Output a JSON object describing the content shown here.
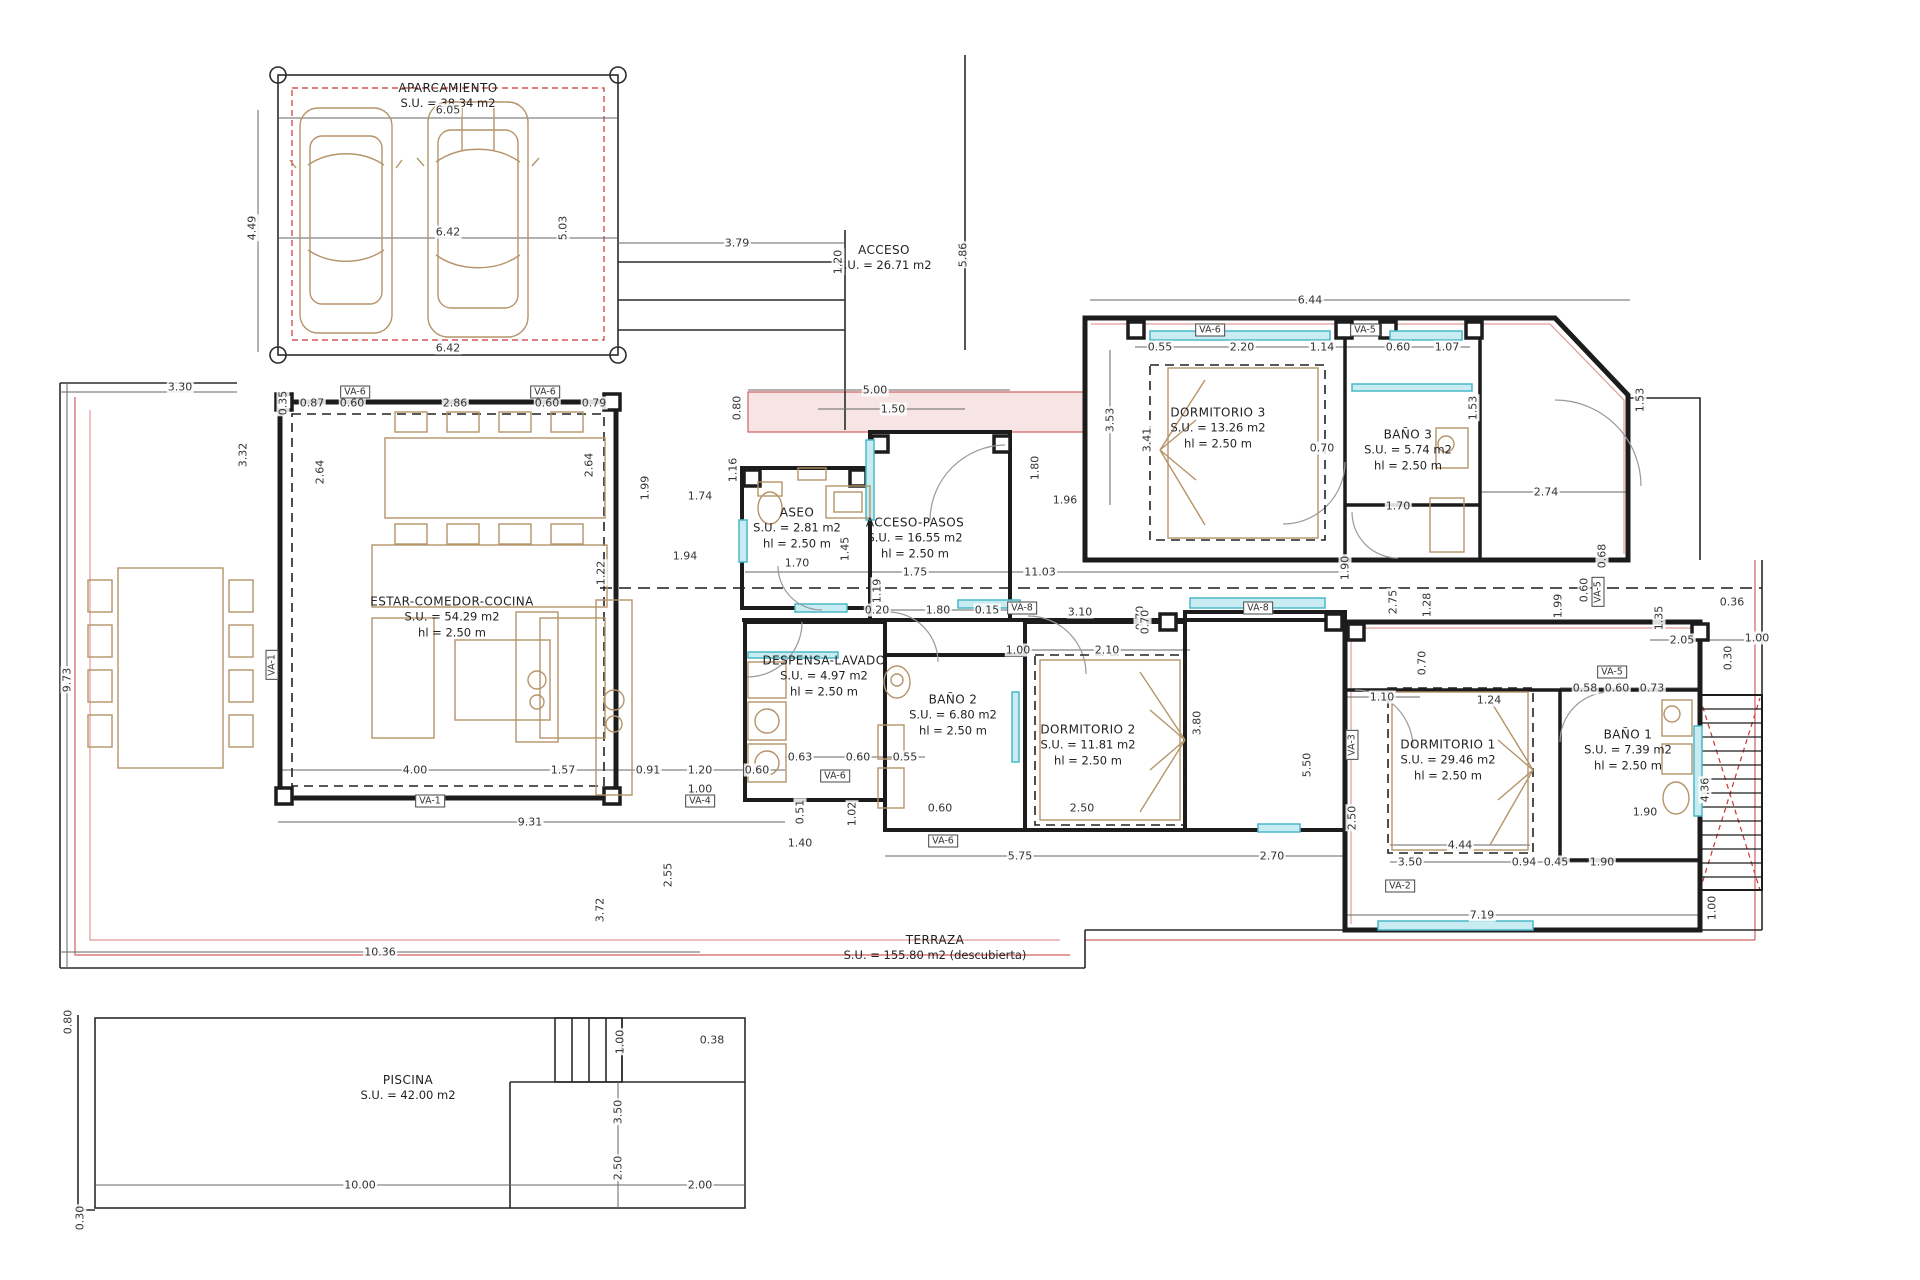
{
  "plan": {
    "colors": {
      "wall": "#1c1c1c",
      "thin_line": "#555555",
      "furniture": "#b5946a",
      "glazing": "#49b8c8",
      "glazing_fill": "#c9ecf2",
      "red_overlay": "#cc3333",
      "pink_overlay": "#e49a9a",
      "text": "#2b2b2b"
    },
    "rooms": [
      {
        "id": "aparcamiento",
        "lines": [
          "APARCAMIENTO",
          "S.U. = 38.34 m2"
        ],
        "x": 448,
        "y": 96
      },
      {
        "id": "acceso",
        "lines": [
          "ACCESO",
          "S.U. = 26.71 m2"
        ],
        "x": 884,
        "y": 258
      },
      {
        "id": "aseo",
        "lines": [
          "ASEO",
          "S.U. = 2.81 m2",
          "hl = 2.50 m"
        ],
        "x": 797,
        "y": 528
      },
      {
        "id": "acceso-pasos",
        "lines": [
          "ACCESO-PASOS",
          "S.U. = 16.55 m2",
          "hl = 2.50 m"
        ],
        "x": 915,
        "y": 538
      },
      {
        "id": "dormitorio-3",
        "lines": [
          "DORMITORIO 3",
          "S.U. = 13.26 m2",
          "hl = 2.50 m"
        ],
        "x": 1218,
        "y": 428
      },
      {
        "id": "bano-3",
        "lines": [
          "BAÑO 3",
          "S.U. = 5.74 m2",
          "hl = 2.50 m"
        ],
        "x": 1408,
        "y": 450
      },
      {
        "id": "estar-comedor-cocina",
        "lines": [
          "ESTAR-COMEDOR-COCINA",
          "S.U. = 54.29 m2",
          "hl = 2.50 m"
        ],
        "x": 452,
        "y": 617
      },
      {
        "id": "despensa-lavado",
        "lines": [
          "DESPENSA-LAVADO",
          "S.U. = 4.97 m2",
          "hl = 2.50 m"
        ],
        "x": 824,
        "y": 676
      },
      {
        "id": "bano-2",
        "lines": [
          "BAÑO 2",
          "S.U. = 6.80 m2",
          "hl = 2.50 m"
        ],
        "x": 953,
        "y": 715
      },
      {
        "id": "dormitorio-2",
        "lines": [
          "DORMITORIO 2",
          "S.U. = 11.81 m2",
          "hl = 2.50 m"
        ],
        "x": 1088,
        "y": 745
      },
      {
        "id": "dormitorio-1",
        "lines": [
          "DORMITORIO 1",
          "S.U. = 29.46 m2",
          "hl = 2.50 m"
        ],
        "x": 1448,
        "y": 760
      },
      {
        "id": "bano-1",
        "lines": [
          "BAÑO 1",
          "S.U. = 7.39 m2",
          "hl = 2.50 m"
        ],
        "x": 1628,
        "y": 750
      },
      {
        "id": "terraza",
        "lines": [
          "TERRAZA",
          "S.U. = 155.80 m2 (descubierta)"
        ],
        "x": 935,
        "y": 948
      },
      {
        "id": "piscina",
        "lines": [
          "PISCINA",
          "S.U. = 42.00 m2"
        ],
        "x": 408,
        "y": 1088
      }
    ],
    "dimensions": [
      [
        "6.05",
        448,
        110,
        0
      ],
      [
        "4.49",
        252,
        228,
        90
      ],
      [
        "6.42",
        448,
        232,
        0
      ],
      [
        "5.03",
        563,
        228,
        90
      ],
      [
        "6.42",
        448,
        348,
        0
      ],
      [
        "3.79",
        737,
        243,
        0
      ],
      [
        "1.20",
        838,
        262,
        90
      ],
      [
        "5.86",
        963,
        255,
        90
      ],
      [
        "5.00",
        875,
        390,
        0
      ],
      [
        "1.50",
        893,
        409,
        0
      ],
      [
        "0.80",
        737,
        408,
        90
      ],
      [
        "3.30",
        180,
        387,
        0
      ],
      [
        "0.35",
        283,
        403,
        90
      ],
      [
        "0.87",
        312,
        403,
        0
      ],
      [
        "0.60",
        352,
        403,
        0
      ],
      [
        "2.86",
        455,
        403,
        0
      ],
      [
        "0.60",
        547,
        403,
        0
      ],
      [
        "0.79",
        594,
        403,
        0
      ],
      [
        "3.32",
        243,
        455,
        90
      ],
      [
        "2.64",
        320,
        472,
        90
      ],
      [
        "2.64",
        589,
        465,
        90
      ],
      [
        "9.73",
        67,
        680,
        90
      ],
      [
        "1.74",
        700,
        496,
        0
      ],
      [
        "1.16",
        733,
        470,
        90
      ],
      [
        "1.99",
        645,
        488,
        90
      ],
      [
        "1.94",
        685,
        556,
        0
      ],
      [
        "1.22",
        601,
        573,
        90
      ],
      [
        "1.45",
        845,
        549,
        90
      ],
      [
        "1.70",
        797,
        563,
        0
      ],
      [
        "1.75",
        915,
        572,
        0
      ],
      [
        "1.19",
        877,
        591,
        90
      ],
      [
        "11.03",
        1040,
        572,
        0
      ],
      [
        "1.90",
        1345,
        568,
        90
      ],
      [
        "1.96",
        1065,
        500,
        0
      ],
      [
        "1.80",
        1035,
        468,
        90
      ],
      [
        "6.44",
        1310,
        300,
        0
      ],
      [
        "3.53",
        1110,
        420,
        90
      ],
      [
        "3.41",
        1147,
        440,
        90
      ],
      [
        "0.55",
        1160,
        347,
        0
      ],
      [
        "2.20",
        1242,
        347,
        0
      ],
      [
        "1.14",
        1322,
        347,
        0
      ],
      [
        "0.60",
        1398,
        347,
        0
      ],
      [
        "1.07",
        1447,
        347,
        0
      ],
      [
        "0.70",
        1322,
        448,
        0
      ],
      [
        "1.70",
        1398,
        506,
        0
      ],
      [
        "2.74",
        1546,
        492,
        0
      ],
      [
        "1.53",
        1473,
        408,
        90
      ],
      [
        "1.53",
        1640,
        400,
        90
      ],
      [
        "0.20",
        877,
        610,
        0
      ],
      [
        "1.80",
        938,
        610,
        0
      ],
      [
        "0.15",
        987,
        610,
        0
      ],
      [
        "3.10",
        1080,
        612,
        0
      ],
      [
        "1.00",
        1018,
        650,
        0
      ],
      [
        "2.10",
        1107,
        650,
        0
      ],
      [
        "0.70",
        1140,
        618,
        90
      ],
      [
        "0.63",
        800,
        757,
        0
      ],
      [
        "0.60",
        858,
        757,
        0
      ],
      [
        "0.55",
        905,
        757,
        0
      ],
      [
        "0.51",
        800,
        812,
        90
      ],
      [
        "1.02",
        852,
        814,
        90
      ],
      [
        "1.40",
        800,
        843,
        0
      ],
      [
        "0.60",
        940,
        808,
        0
      ],
      [
        "2.50",
        1082,
        808,
        0
      ],
      [
        "5.75",
        1020,
        856,
        0
      ],
      [
        "2.70",
        1272,
        856,
        0
      ],
      [
        "4.00",
        415,
        770,
        0
      ],
      [
        "1.57",
        563,
        770,
        0
      ],
      [
        "0.91",
        648,
        770,
        0
      ],
      [
        "1.20",
        700,
        770,
        0
      ],
      [
        "0.60",
        757,
        770,
        0
      ],
      [
        "1.00",
        700,
        789,
        0
      ],
      [
        "9.31",
        530,
        822,
        0
      ],
      [
        "2.55",
        668,
        875,
        90
      ],
      [
        "3.72",
        600,
        910,
        90
      ],
      [
        "10.36",
        380,
        952,
        0
      ],
      [
        "3.80",
        1197,
        723,
        90
      ],
      [
        "5.50",
        1307,
        765,
        90
      ],
      [
        "0.70",
        1145,
        622,
        90
      ],
      [
        "2.75",
        1393,
        602,
        90
      ],
      [
        "1.28",
        1427,
        605,
        90
      ],
      [
        "0.70",
        1422,
        663,
        90
      ],
      [
        "1.10",
        1382,
        697,
        0
      ],
      [
        "1.24",
        1489,
        700,
        0
      ],
      [
        "0.58",
        1585,
        688,
        0
      ],
      [
        "0.60",
        1617,
        688,
        0
      ],
      [
        "0.73",
        1652,
        688,
        0
      ],
      [
        "2.05",
        1682,
        640,
        0
      ],
      [
        "1.00",
        1757,
        638,
        0
      ],
      [
        "0.30",
        1728,
        658,
        90
      ],
      [
        "0.36",
        1732,
        602,
        0
      ],
      [
        "1.35",
        1659,
        618,
        90
      ],
      [
        "1.99",
        1558,
        606,
        90
      ],
      [
        "0.68",
        1602,
        556,
        90
      ],
      [
        "0.60",
        1584,
        590,
        90
      ],
      [
        "2.50",
        1352,
        818,
        90
      ],
      [
        "4.44",
        1460,
        845,
        0
      ],
      [
        "3.50",
        1410,
        862,
        0
      ],
      [
        "0.94",
        1524,
        862,
        0
      ],
      [
        "0.45",
        1556,
        862,
        0
      ],
      [
        "1.90",
        1602,
        862,
        0
      ],
      [
        "1.90",
        1645,
        812,
        0
      ],
      [
        "7.19",
        1482,
        915,
        0
      ],
      [
        "1.00",
        1712,
        908,
        90
      ],
      [
        "4.36",
        1705,
        790,
        90
      ],
      [
        "0.80",
        68,
        1022,
        90
      ],
      [
        "0.30",
        80,
        1218,
        90
      ],
      [
        "1.00",
        620,
        1042,
        90
      ],
      [
        "0.38",
        712,
        1040,
        0
      ],
      [
        "3.50",
        618,
        1112,
        90
      ],
      [
        "2.50",
        618,
        1168,
        90
      ],
      [
        "10.00",
        360,
        1185,
        0
      ],
      [
        "2.00",
        700,
        1185,
        0
      ]
    ],
    "window_tags": [
      [
        "VA-6",
        355,
        392,
        0
      ],
      [
        "VA-6",
        545,
        392,
        0
      ],
      [
        "VA-1",
        272,
        665,
        90
      ],
      [
        "VA-1",
        430,
        801,
        0
      ],
      [
        "VA-4",
        700,
        801,
        0
      ],
      [
        "VA-6",
        835,
        776,
        0
      ],
      [
        "VA-6",
        943,
        841,
        0
      ],
      [
        "VA-6",
        1210,
        330,
        0
      ],
      [
        "VA-5",
        1365,
        330,
        0
      ],
      [
        "VA-8",
        1022,
        608,
        0
      ],
      [
        "VA-8",
        1258,
        608,
        0
      ],
      [
        "VA-3",
        1352,
        745,
        90
      ],
      [
        "VA-5",
        1598,
        592,
        90
      ],
      [
        "VA-5",
        1612,
        672,
        0
      ],
      [
        "VA-2",
        1400,
        886,
        0
      ]
    ]
  }
}
